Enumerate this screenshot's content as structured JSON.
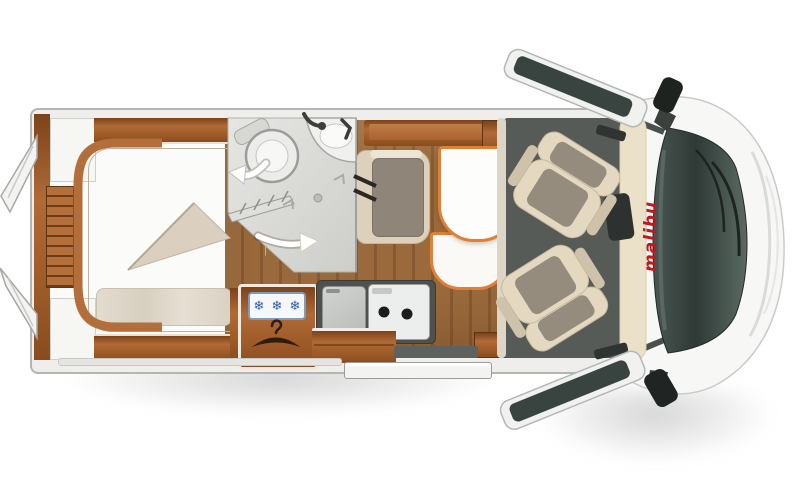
{
  "image": {
    "label": "Motorhome floor plan, top view"
  },
  "branding": {
    "logo_text": "malibu",
    "logo_color": "#c4161c"
  },
  "fridge_panel": {
    "snowflakes": [
      "❄",
      "❄",
      "❄"
    ]
  },
  "icons": {
    "snowflake": "❄",
    "hanger": "clothes-hanger",
    "bathroom_swivel_arrow": "curved-left-arrow",
    "walkway_arrow": "right-arrow",
    "burners": "two-burner-hob"
  },
  "colors": {
    "wood_cabinet": "#b06a36",
    "wood_floor": "#9a6a3c",
    "mattress": "#cdc2b1",
    "seat_beige": "#e4d8c0",
    "cushion_gray": "#968c7e",
    "table_rim": "#df8038",
    "table_top": "#fdfdfb",
    "cab_floor": "#565b57",
    "windshield": "#3a4542",
    "body_white": "#f7f8f6",
    "logo_red": "#c4161c",
    "snowflake_blue": "#2b5f9e"
  }
}
